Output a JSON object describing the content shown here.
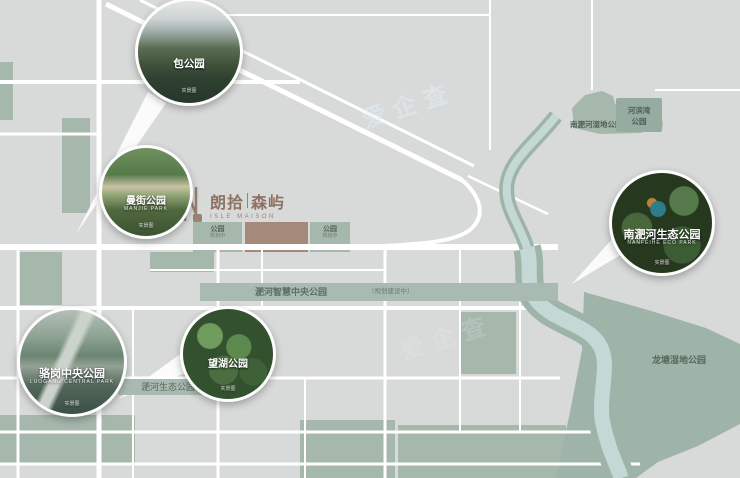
{
  "colors": {
    "map_bg": "#d8dad9",
    "road": "#ffffff",
    "park_green": "#a6b7ac",
    "river_water": "#c4d9d6",
    "river_bank": "#9fb4a9",
    "brand": "#9c8172",
    "project_plot": "#a5897a"
  },
  "watermark": {
    "text": "爱企查"
  },
  "logo": {
    "cn": "朗拾",
    "divider": "|",
    "cn2": "森屿",
    "en": "ISLE MAISON"
  },
  "callouts": [
    {
      "title": "包公园",
      "en": "",
      "note": "实景图"
    },
    {
      "title": "曼街公园",
      "en": "MANJIE PARK",
      "note": "实景图"
    },
    {
      "title": "骆岗中央公园",
      "en": "LUOGANG CENTRAL PARK",
      "note": "实景图"
    },
    {
      "title": "望湖公园",
      "en": "",
      "note": "实景图"
    },
    {
      "title": "南淝河生态公园",
      "en": "NANFEIHE ECO PARK",
      "note": "实景图"
    }
  ],
  "labels": {
    "smart_central_park": "淝河智慧中央公园",
    "smart_central_park_note": "（规划建设中）",
    "eco_park": "淝河生态公园",
    "longtang": "龙塘湿地公园",
    "riverside_wetland": "南淝河湿地公园",
    "corner_park_line1": "河滨湾",
    "corner_park_line2": "公园",
    "planned_park_1": "公园",
    "planned_park_1_note": "规划中",
    "planned_park_2": "公园",
    "planned_park_2_note": "规划中"
  }
}
